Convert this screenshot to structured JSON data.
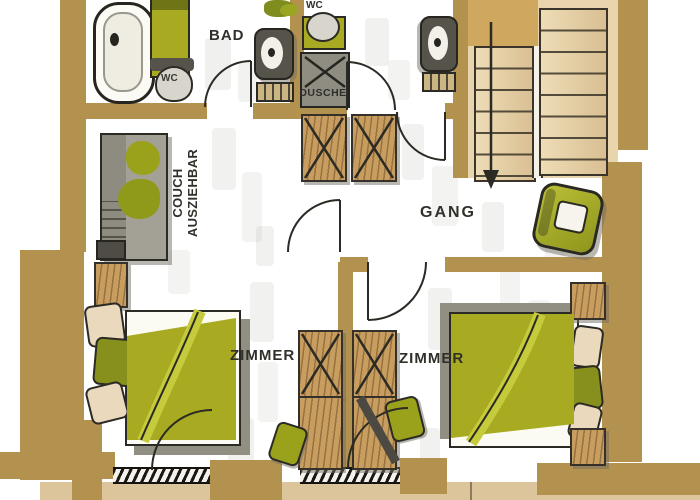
{
  "document": {
    "kind": "hand-drawn apartment floor plan sketch",
    "language": "German"
  },
  "palette": {
    "wall_tan": "#b3914f",
    "stair_tread": "#e8d5ae",
    "stair_landing": "#cfa75f",
    "wood_furniture": "#c79d60",
    "olive_green": "#a8aa22",
    "olive_bright": "#c6cb3c",
    "olive_dark": "#87901c",
    "furniture_gray": "#9a988c",
    "shadow_gray": "#918f82",
    "ink": "#2b2a24",
    "balcony_floor": "#dcc59a",
    "paper": "#ffffff"
  },
  "labels": {
    "bad": "BAD",
    "wc_bad": "WC",
    "wc_small": "WC",
    "dusche": "DUSCHE",
    "gang": "GANG",
    "zimmer_left": "ZIMMER",
    "zimmer_right": "ZIMMER",
    "couch_line1": "COUCH",
    "couch_line2": "AUSZIEHBAR"
  },
  "elements": [
    "bathtub",
    "toilet",
    "washbasin",
    "shower",
    "towel-rail",
    "wardrobe-crossed",
    "pull-out-couch",
    "double-bed",
    "pillows",
    "nightstand",
    "armchair",
    "staircase-down-arrow",
    "door-swing",
    "balcony",
    "glazed-threshold",
    "plant"
  ]
}
